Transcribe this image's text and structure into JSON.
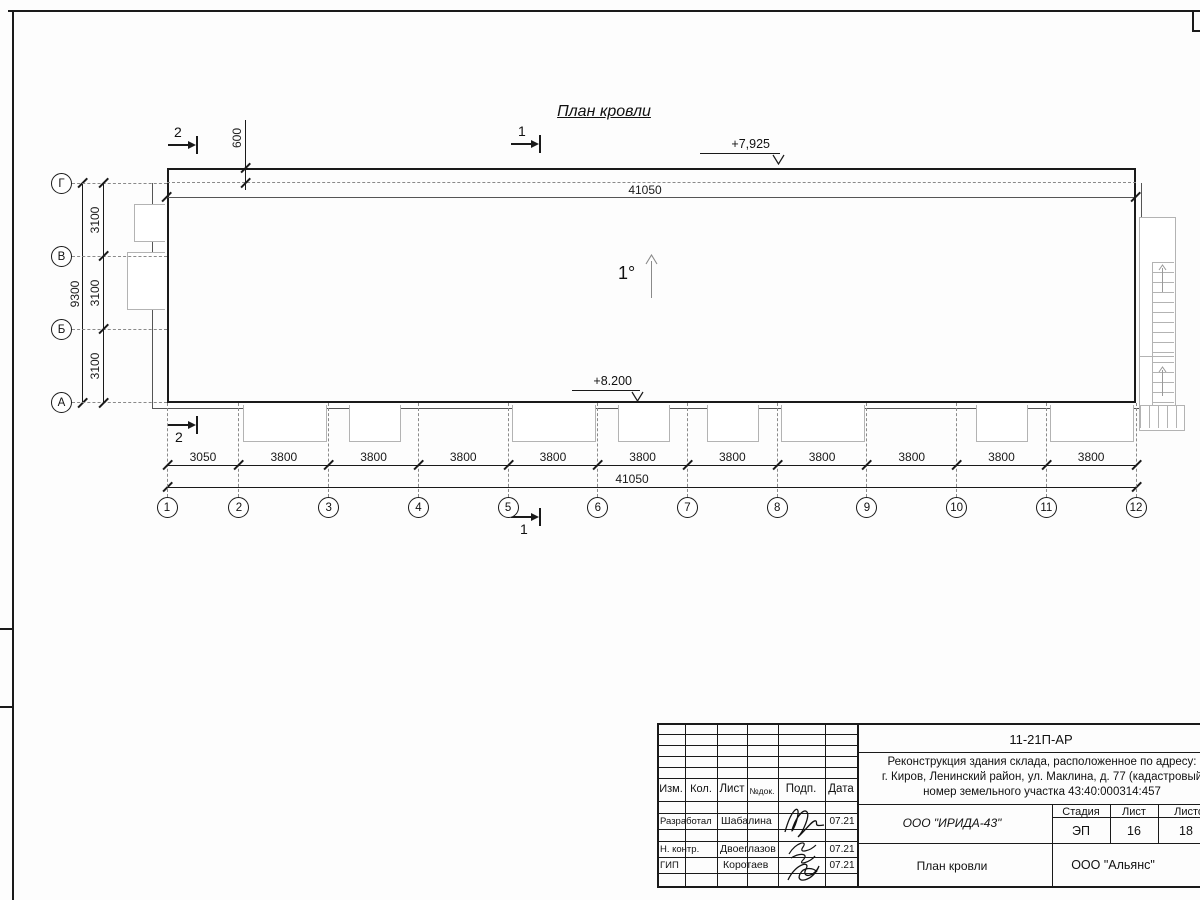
{
  "drawing": {
    "title": "План кровли",
    "slope": "1°",
    "elevation_top": "+7,925",
    "elevation_bottom": "+8.200",
    "overhang_dim": "600",
    "top_total_dim": "41050",
    "section_1": "1",
    "section_2": "2",
    "left_axes": [
      "Г",
      "В",
      "Б",
      "А"
    ],
    "left_dims": {
      "segments": [
        "3100",
        "3100",
        "3100"
      ],
      "total": "9300"
    },
    "bottom_axes": [
      "1",
      "2",
      "3",
      "4",
      "5",
      "6",
      "7",
      "8",
      "9",
      "10",
      "11",
      "12"
    ],
    "bottom_dims": {
      "segments": [
        "3050",
        "3800",
        "3800",
        "3800",
        "3800",
        "3800",
        "3800",
        "3800",
        "3800",
        "3800",
        "3800"
      ],
      "total": "41050"
    },
    "canopies": [
      {
        "bay": 1,
        "size": "wide"
      },
      {
        "bay": 2,
        "size": "small"
      },
      {
        "bay": 4,
        "size": "wide"
      },
      {
        "bay": 5,
        "size": "small"
      },
      {
        "bay": 6,
        "size": "small"
      },
      {
        "bay": 7,
        "size": "wide"
      },
      {
        "bay": 9,
        "size": "small"
      },
      {
        "bay": 10,
        "size": "wide"
      }
    ]
  },
  "title_block": {
    "doc_number": "11-21П-АР",
    "project_line1": "Реконструкция здания склада, расположенное по адресу:",
    "project_line2": "г. Киров, Ленинский район, ул. Маклина, д. 77 (кадастровый",
    "project_line3": "номер земельного участка 43:40:000314:457",
    "col_izm": "Изм.",
    "col_kol": "Кол.",
    "col_list": "Лист",
    "col_ndok": "№док.",
    "col_podp": "Подп.",
    "col_data": "Дата",
    "rows": [
      {
        "role": "Разработал",
        "name": "Шабалина",
        "date": "07.21"
      },
      {
        "role": "Н. контр.",
        "name": "Двоеглазов",
        "date": "07.21"
      },
      {
        "role": "ГИП",
        "name": "Коротаев",
        "date": "07.21"
      }
    ],
    "designer_org": "ООО \"ИРИДА-43\"",
    "stage_label": "Стадия",
    "sheet_label": "Лист",
    "sheets_label": "Листов",
    "stage": "ЭП",
    "sheet_number": "16",
    "sheets_total": "18",
    "drawing_name": "План кровли",
    "company": "ООО \"Альянс\""
  }
}
